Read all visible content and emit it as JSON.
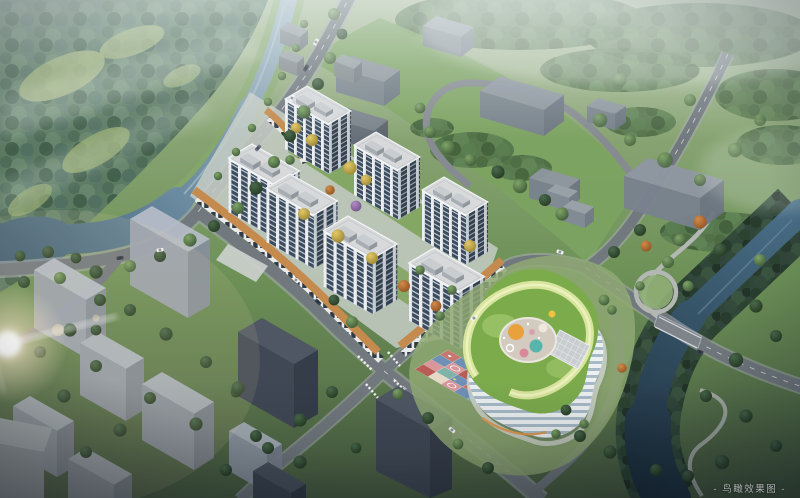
{
  "image": {
    "type": "aerial-architectural-rendering",
    "caption": "- 鸟瞰效果图 -",
    "subject": "Bird's-eye rendering: six white residential towers over an orange retail podium, a kindergarten with green landscaped roof and colorful playground, grey context massing, tree-lined streets and two rivers"
  },
  "scene": {
    "tower_count": 6
  },
  "palette": {
    "river": "#6b8ba0",
    "river_dark": "#22384a",
    "grass": "#6e9258",
    "forest": "#52734b",
    "road": "#71787e",
    "tower_face": "#eceef0",
    "tower_glass": "#3d4d5f",
    "podium": "#c48a4e",
    "kindergarten_roof": "#7cab4c",
    "kindergarten_path": "#dde8a2",
    "context_building": "#9aa2b0",
    "playground_red": "#b85c55",
    "playground_blue": "#6f90b5",
    "playground_pink": "#d9969b",
    "playground_teal": "#7fb3a8"
  }
}
